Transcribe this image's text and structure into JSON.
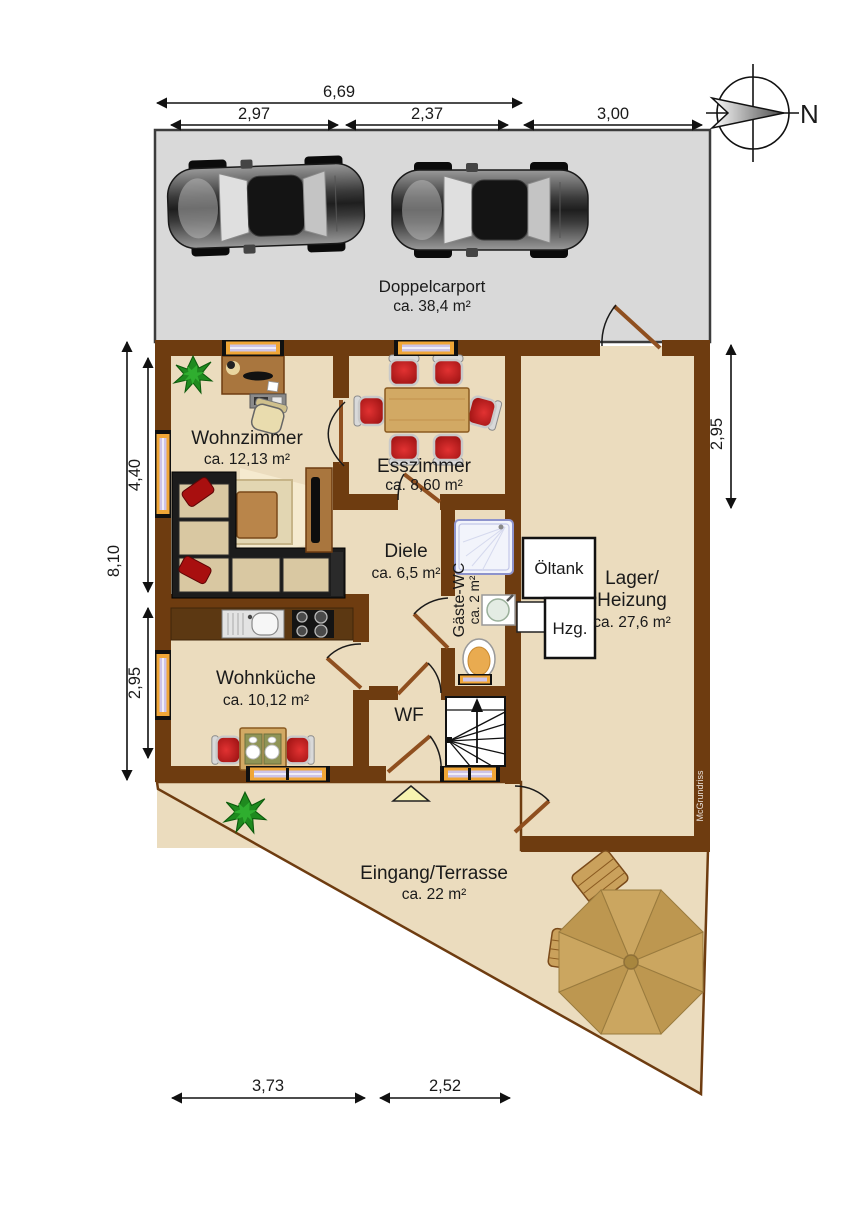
{
  "colors": {
    "wall": "#6e3c10",
    "floor": "#ebdcbe",
    "carport": "#d9d9d9",
    "winframe": "#f0a637",
    "winglass": "#cdc4e8",
    "wood": "#d2a964",
    "woodDark": "#a9763e",
    "red": "#c01616",
    "parasol": "#c7a25c",
    "plant": "#1f8a1f",
    "line": "#111111"
  },
  "compass": {
    "north_label": "N"
  },
  "watermark": {
    "text": "McGrundriss"
  },
  "dims": {
    "top_total": "6,69",
    "top_seg1": "2,97",
    "top_seg2": "2,37",
    "top_seg3": "3,00",
    "left_total": "8,10",
    "left_upper": "4,40",
    "left_lower": "2,95",
    "right_upper": "2,95",
    "bottom_seg1": "3,73",
    "bottom_seg2": "2,52"
  },
  "rooms": {
    "carport": {
      "name": "Doppelcarport",
      "area": "ca. 38,4 m²"
    },
    "wohnzimmer": {
      "name": "Wohnzimmer",
      "area": "ca. 12,13 m²"
    },
    "esszimmer": {
      "name": "Esszimmer",
      "area": "ca. 8,60 m²"
    },
    "diele": {
      "name": "Diele",
      "area": "ca. 6,5 m²"
    },
    "gaeste_wc": {
      "name": "Gäste-WC",
      "area": "ca. 2 m²"
    },
    "lager": {
      "name_line1": "Lager/",
      "name_line2": "Heizung",
      "area": "ca. 27,6 m²"
    },
    "wohnkueche": {
      "name": "Wohnküche",
      "area": "ca. 10,12 m²"
    },
    "windfang": {
      "name": "WF"
    },
    "eingang": {
      "name": "Eingang/Terrasse",
      "area": "ca. 22 m²"
    }
  },
  "equipment": {
    "oil_tank": "Öltank",
    "heater": "Hzg."
  }
}
